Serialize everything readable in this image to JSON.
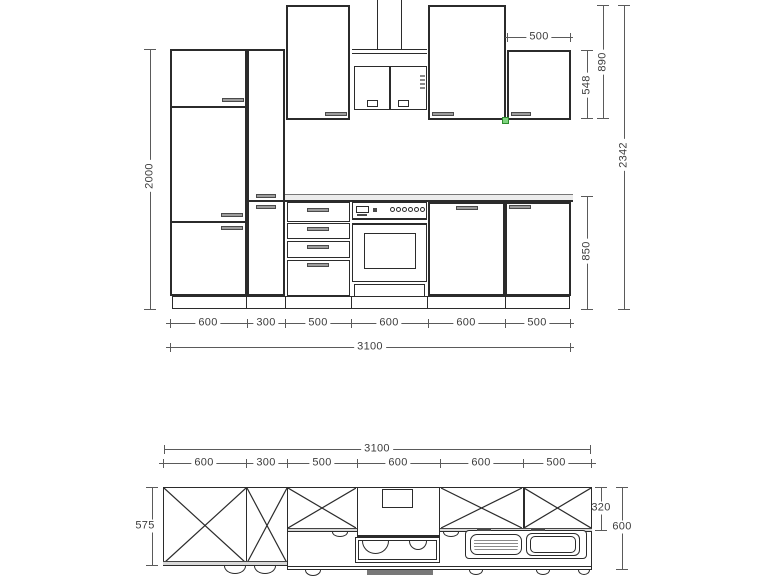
{
  "elevation": {
    "left_height_mm": "2000",
    "top_cabinet_width_mm": "500",
    "right": {
      "short_cabinet_mm": "548",
      "tall_cabinet_mm": "890",
      "total_height_mm": "2342",
      "base_height_mm": "850"
    },
    "bottom_segments_mm": [
      "600",
      "300",
      "500",
      "600",
      "600",
      "500"
    ],
    "total_width_mm": "3100"
  },
  "plan": {
    "total_width_mm": "3100",
    "segments_mm": [
      "600",
      "300",
      "500",
      "600",
      "600",
      "500"
    ],
    "left_depth_mm": "575",
    "wall_cabinet_depth_mm": "320",
    "worktop_depth_mm": "600"
  },
  "colors": {
    "line": "#2b2b2b",
    "dim_line": "#5a5a5a",
    "handle_fill": "#9c9c9c",
    "snap_marker": "#7ed47e",
    "appliance_front": "#787878"
  }
}
